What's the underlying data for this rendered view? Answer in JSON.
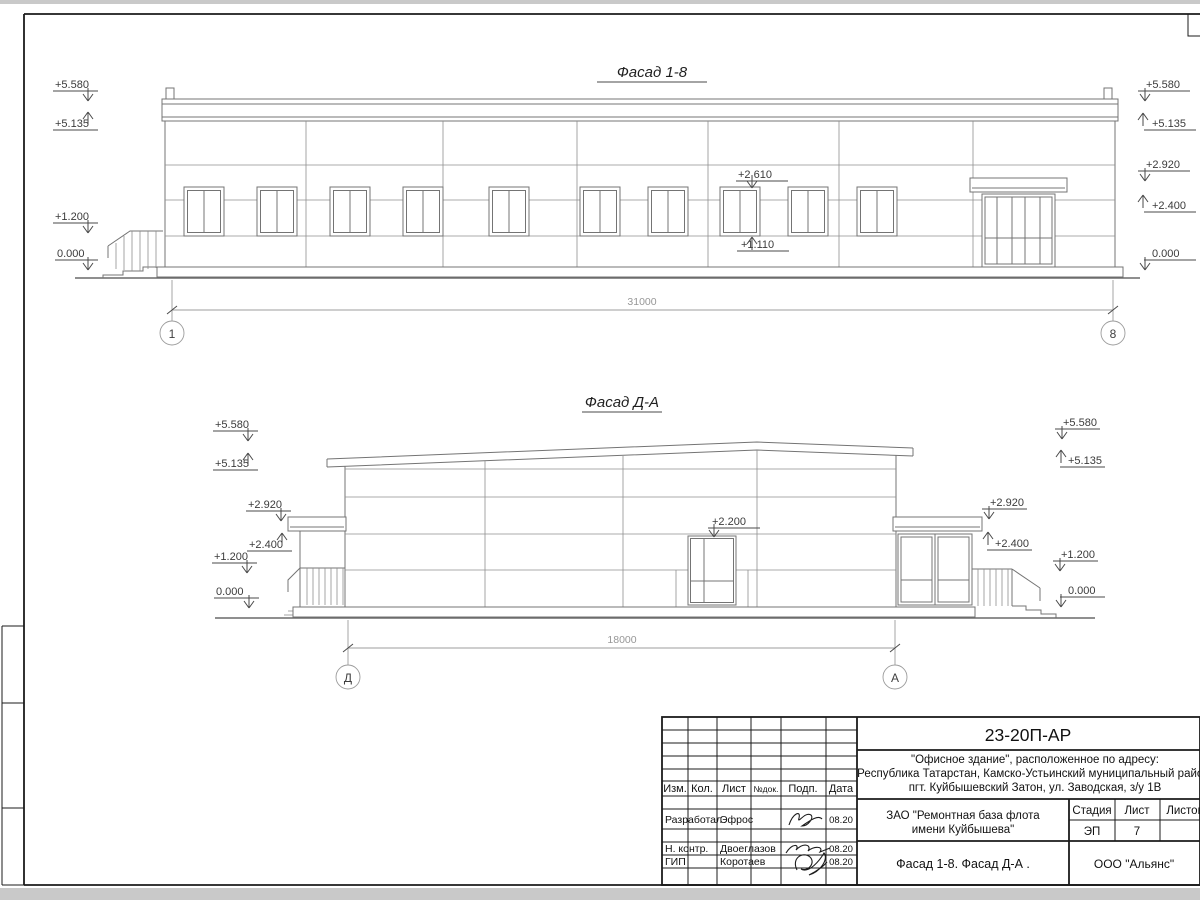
{
  "sheet": {
    "frame_color": "#1b1b1b",
    "drawing_line_color": "#747474",
    "background": "#ffffff"
  },
  "facade1": {
    "title": "Фасад 1-8",
    "marks": {
      "left": [
        "+5.580",
        "+5.135",
        "+1.200",
        "0.000"
      ],
      "right": [
        "+5.580",
        "+5.135",
        "+2.920",
        "+2.400",
        "0.000"
      ],
      "window_head": "+2.610",
      "window_sill": "+1.110"
    },
    "dimension": "31000",
    "axes": [
      "1",
      "8"
    ]
  },
  "facade2": {
    "title": "Фасад Д-А",
    "marks": {
      "left": [
        "+5.580",
        "+5.135",
        "+2.920",
        "+2.400",
        "+1.200",
        "0.000"
      ],
      "right": [
        "+5.580",
        "+5.135",
        "+2.920",
        "+2.400",
        "+1.200",
        "0.000"
      ],
      "door_head": "+2.200"
    },
    "dimension": "18000",
    "axes": [
      "Д",
      "А"
    ]
  },
  "titleblock": {
    "doc": "23-20П-АР",
    "object_lines": [
      "\"Офисное здание\", расположенное по адресу:",
      "Республика Татарстан, Камско-Устьинский муниципальный район,",
      "пгт. Куйбышевский Затон, ул. Заводская, з/у 1В"
    ],
    "client_lines": [
      "ЗАО \"Ремонтная база флота",
      "имени Куйбышева\""
    ],
    "drawing_title": "Фасад 1-8. Фасад Д-А .",
    "company": "ООО \"Альянс\"",
    "stage_label": "Стадия",
    "stage_value": "ЭП",
    "sheet_label": "Лист",
    "sheet_value": "7",
    "sheets_label": "Листов",
    "header_cols": [
      "Изм.",
      "Кол.",
      "Лист",
      "№док.",
      "Подп.",
      "Дата"
    ],
    "sign_rows": [
      {
        "role": "Разработал",
        "name": "Эфрос",
        "date": "08.20"
      },
      {
        "role": "Н. контр.",
        "name": "Двоеглазов",
        "date": "08.20"
      },
      {
        "role": "ГИП",
        "name": "Коротаев",
        "date": "08.20"
      }
    ]
  }
}
